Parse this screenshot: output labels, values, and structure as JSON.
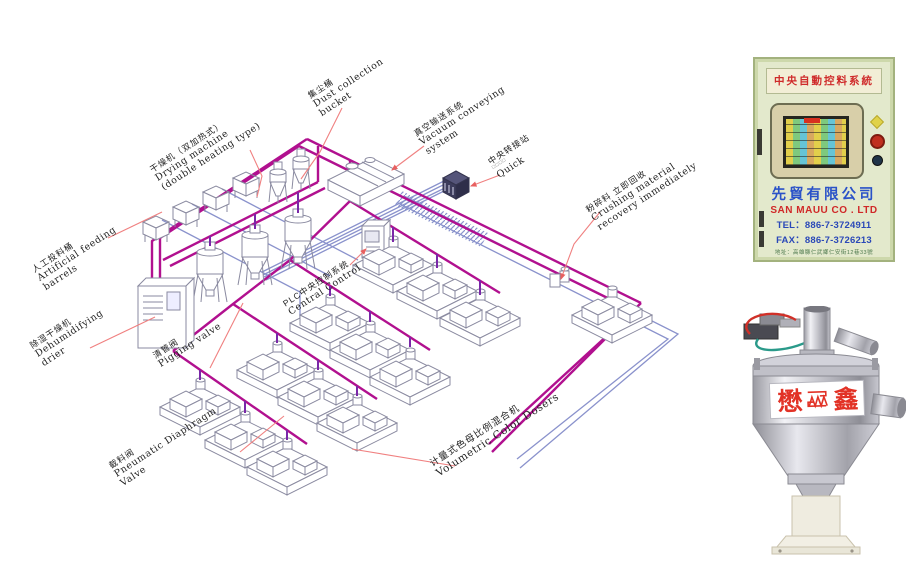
{
  "diagram": {
    "labels": {
      "feeding": {
        "zh": "人工投料桶",
        "en1": "Artificial feeding",
        "en2": "barrels"
      },
      "drying": {
        "zh": "干燥机（双加热式）",
        "en1": "Drying machine",
        "en2": "(double heating type)"
      },
      "dust": {
        "zh": "集尘桶",
        "en1": "Dust collection",
        "en2": "bucket"
      },
      "vacuum": {
        "zh": "真空输送系统",
        "en1": "Vacuum conveying",
        "en2": "system"
      },
      "transfer": {
        "zh": "中央转接站",
        "sub": "□□□□",
        "en1": "Quick"
      },
      "crushing": {
        "zh": "粉碎料 立即回收",
        "en1": "Crushing material",
        "en2": "recovery immediately"
      },
      "plc": {
        "zh": "PLC中央控制系统",
        "en1": "Central Control"
      },
      "dehumidifying": {
        "zh": "除湿干燥机",
        "en1": "Dehumidifying",
        "en2": "drier"
      },
      "pigging": {
        "zh": "清管阀",
        "en1": "Pigging valve"
      },
      "diaphragm": {
        "zh": "截料阀",
        "en1": "Pneumatic Diaphragm",
        "en2": "Valve"
      },
      "dosers": {
        "zh": "计量式色母比例混合机",
        "en1": "Volumetric Color Dosers"
      }
    },
    "colors": {
      "main_pipe": "#b1108f",
      "drop_pipe": "#7a28a8",
      "return_pipe": "#8a92cc",
      "leader_line": "#f08080",
      "equipment_outline": "#8a8aa0"
    }
  },
  "cabinet_photo": {
    "title": "中央自動控料系統",
    "company_zh": "先貿有限公司",
    "company_en": "SAN MAUU CO . LTD",
    "tel": "TEL：886-7-3724911",
    "fax": "FAX：886-7-3726213",
    "address": "地址：高雄縣仁武鄉仁安街12巷33號"
  },
  "hopper_photo": {
    "brand_left": "懋",
    "brand_right": "鑫"
  }
}
